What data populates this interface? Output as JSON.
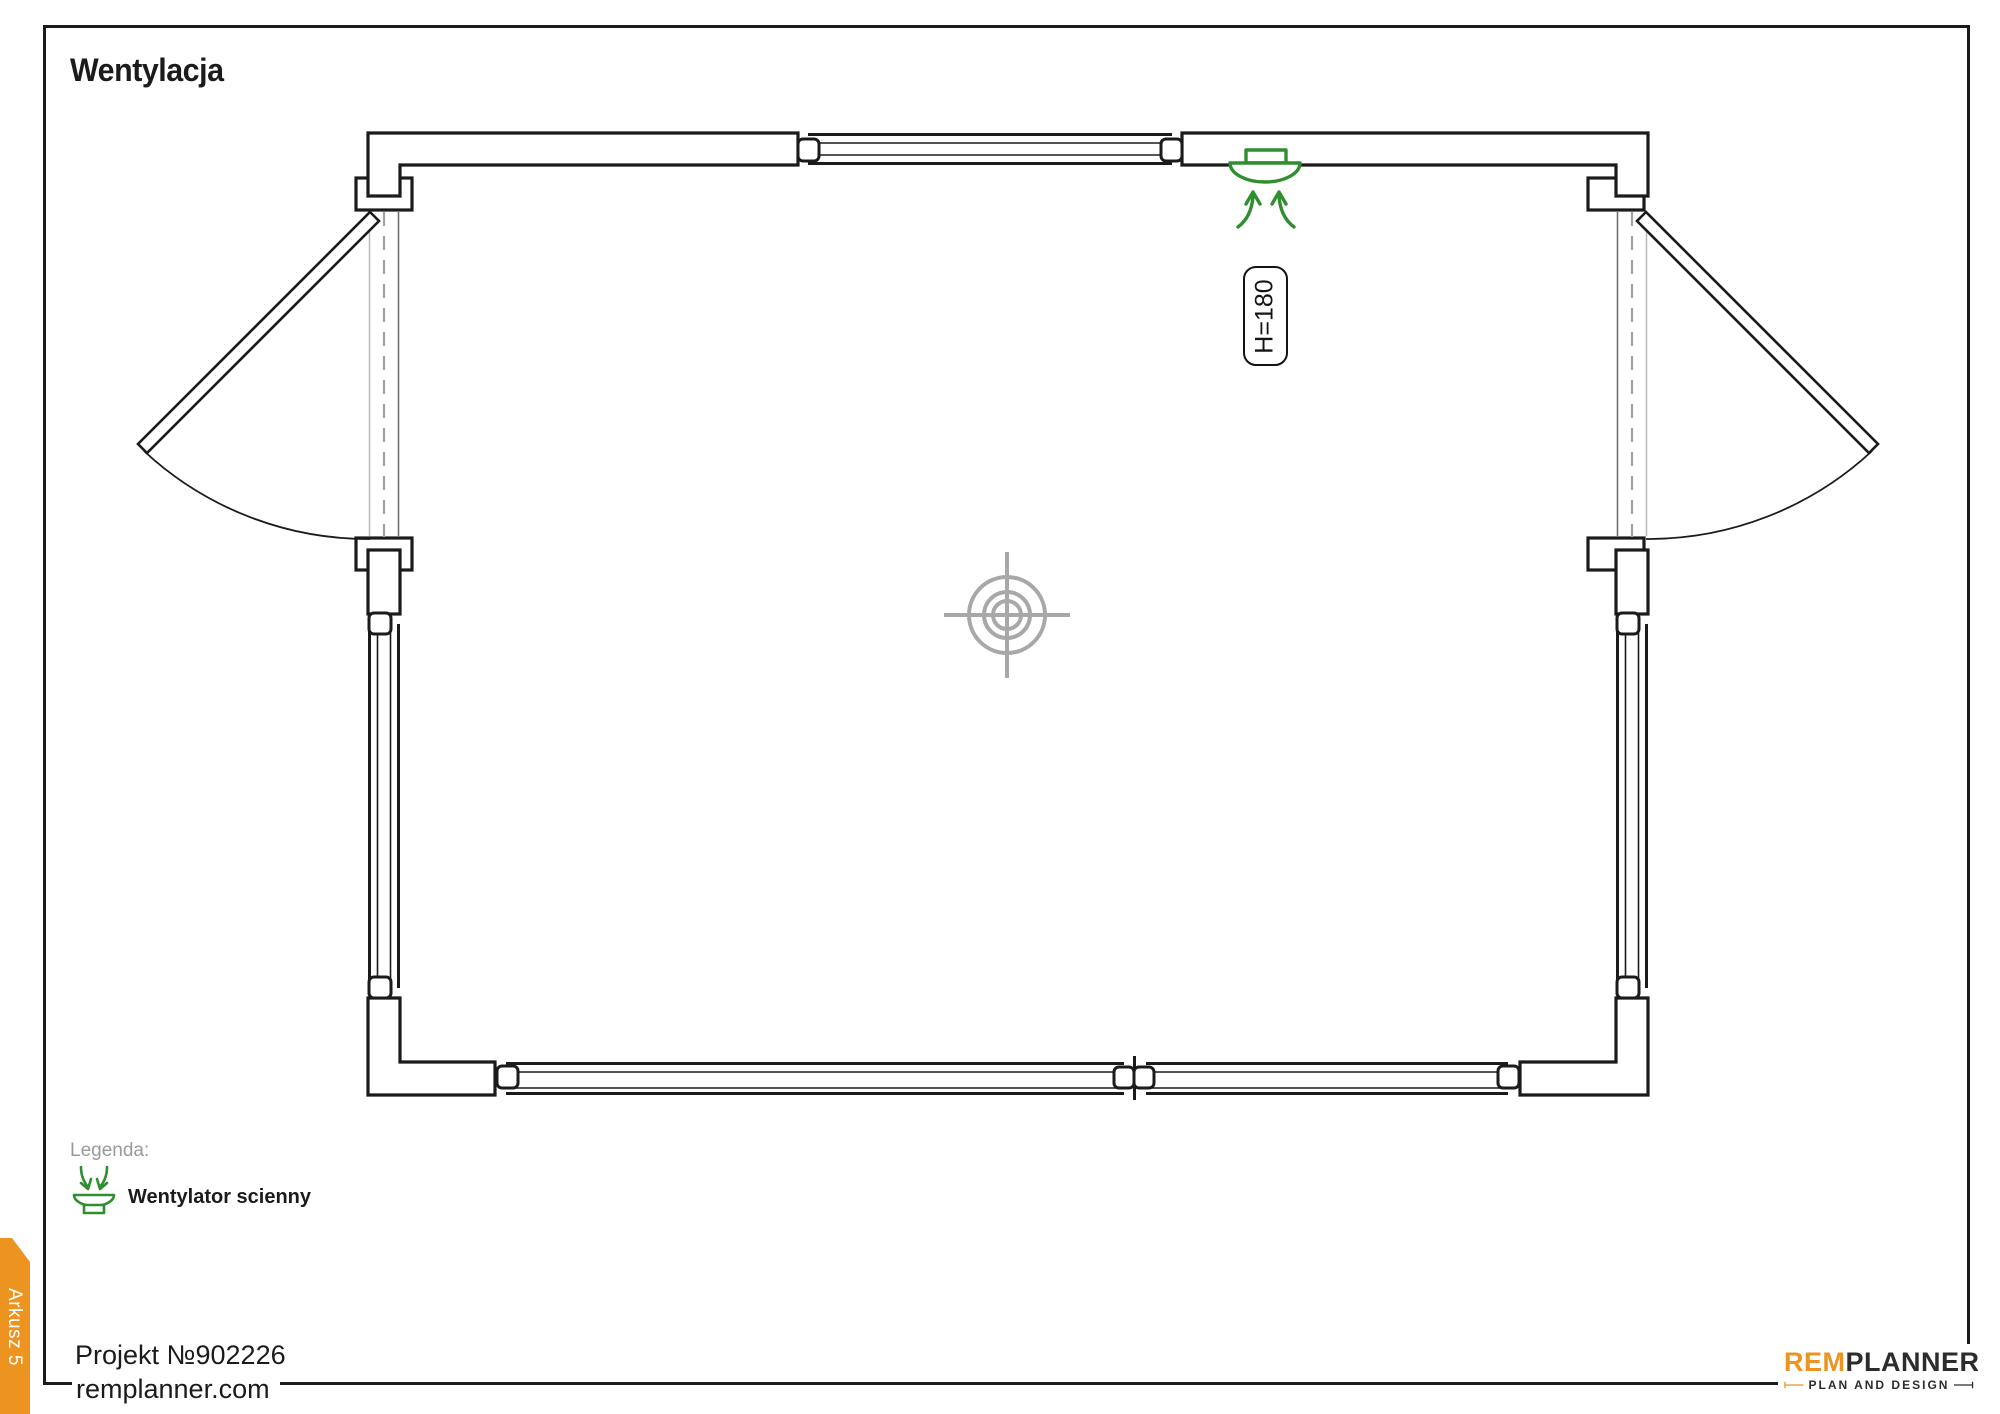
{
  "page": {
    "title": "Wentylacja"
  },
  "plan": {
    "fan_height_label": "H=180"
  },
  "legend": {
    "heading": "Legenda:",
    "items": [
      {
        "icon": "wall-fan-icon",
        "label": "Wentylator scienny"
      }
    ]
  },
  "footer": {
    "project_number": "Projekt №902226",
    "website": "remplanner.com"
  },
  "sheet_tab": {
    "label": "Arkusz 5"
  },
  "brand": {
    "name_accent": "REM",
    "name_rest": "PLANNER",
    "tagline": "PLAN AND DESIGN"
  },
  "colors": {
    "accent_orange": "#ec9320",
    "fan_green": "#2f8f2f",
    "line_dark": "#1b1b1b",
    "line_gray": "#a8a8a8"
  }
}
